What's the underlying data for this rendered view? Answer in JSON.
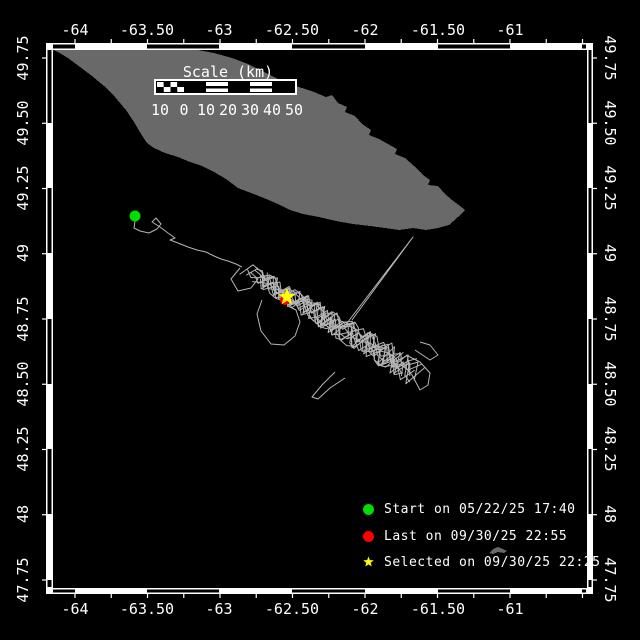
{
  "colors": {
    "background": "#000000",
    "frame": "#ffffff",
    "land": "#696969",
    "track": "#b5b5b5",
    "start_marker": "#00dd00",
    "last_marker": "#ff0000",
    "selected_marker": "#ffff00",
    "text": "#ffffff"
  },
  "axis": {
    "lon_labels": [
      {
        "text": "-64",
        "x": 75
      },
      {
        "text": "-63.50",
        "x": 147
      },
      {
        "text": "-63",
        "x": 219
      },
      {
        "text": "-62.50",
        "x": 292
      },
      {
        "text": "-62",
        "x": 365
      },
      {
        "text": "-61.50",
        "x": 438
      },
      {
        "text": "-61",
        "x": 510
      }
    ],
    "lat_labels": [
      {
        "text": "49.75",
        "y": 58
      },
      {
        "text": "49.50",
        "y": 123
      },
      {
        "text": "49.25",
        "y": 188
      },
      {
        "text": "49",
        "y": 253
      },
      {
        "text": "48.75",
        "y": 319
      },
      {
        "text": "48.50",
        "y": 384
      },
      {
        "text": "48.25",
        "y": 449
      },
      {
        "text": "48",
        "y": 514
      },
      {
        "text": "47.75",
        "y": 580
      }
    ]
  },
  "scalebar": {
    "title": "Scale (km)",
    "labels": [
      "10",
      "0",
      "10",
      "20",
      "30",
      "40",
      "50"
    ],
    "label_xs": [
      160,
      184,
      206,
      228,
      250,
      272,
      294
    ]
  },
  "legend": [
    {
      "marker": "circle",
      "color": "#00dd00",
      "label": "Start on 05/22/25 17:40"
    },
    {
      "marker": "circle",
      "color": "#ff0000",
      "label": "Last on 09/30/25 22:55"
    },
    {
      "marker": "star",
      "color": "#ffff00",
      "label": "Selected on 09/30/25 22:25"
    }
  ],
  "map": {
    "markers": {
      "start": {
        "x": 135,
        "y": 216
      },
      "last": {
        "x": 285,
        "y": 300
      },
      "selected": {
        "x": 287,
        "y": 297
      }
    },
    "land_polygon": [
      [
        53,
        50
      ],
      [
        198,
        50
      ],
      [
        214,
        53
      ],
      [
        232,
        58
      ],
      [
        248,
        64
      ],
      [
        262,
        71
      ],
      [
        276,
        78
      ],
      [
        289,
        84
      ],
      [
        302,
        88
      ],
      [
        314,
        92
      ],
      [
        326,
        97
      ],
      [
        332,
        95
      ],
      [
        338,
        103
      ],
      [
        347,
        107
      ],
      [
        345,
        112
      ],
      [
        355,
        116
      ],
      [
        362,
        124
      ],
      [
        371,
        130
      ],
      [
        369,
        135
      ],
      [
        379,
        139
      ],
      [
        388,
        144
      ],
      [
        397,
        149
      ],
      [
        395,
        154
      ],
      [
        405,
        158
      ],
      [
        414,
        166
      ],
      [
        423,
        175
      ],
      [
        430,
        180
      ],
      [
        428,
        185
      ],
      [
        438,
        186
      ],
      [
        445,
        194
      ],
      [
        452,
        200
      ],
      [
        460,
        206
      ],
      [
        465,
        210
      ],
      [
        458,
        217
      ],
      [
        449,
        225
      ],
      [
        438,
        228
      ],
      [
        426,
        230
      ],
      [
        413,
        228
      ],
      [
        399,
        230
      ],
      [
        385,
        228
      ],
      [
        370,
        226
      ],
      [
        353,
        224
      ],
      [
        336,
        221
      ],
      [
        319,
        217
      ],
      [
        303,
        214
      ],
      [
        290,
        210
      ],
      [
        278,
        204
      ],
      [
        264,
        198
      ],
      [
        251,
        193
      ],
      [
        238,
        188
      ],
      [
        226,
        179
      ],
      [
        214,
        172
      ],
      [
        202,
        166
      ],
      [
        190,
        162
      ],
      [
        178,
        157
      ],
      [
        165,
        153
      ],
      [
        154,
        148
      ],
      [
        147,
        143
      ],
      [
        141,
        134
      ],
      [
        134,
        122
      ],
      [
        126,
        110
      ],
      [
        115,
        97
      ],
      [
        104,
        86
      ],
      [
        92,
        76
      ],
      [
        80,
        67
      ],
      [
        68,
        58
      ],
      [
        58,
        52
      ]
    ],
    "small_island": [
      [
        489,
        553
      ],
      [
        493,
        549
      ],
      [
        498,
        547
      ],
      [
        503,
        549
      ],
      [
        507,
        551
      ],
      [
        504,
        553
      ],
      [
        498,
        552
      ],
      [
        493,
        554
      ]
    ],
    "approach_path": [
      [
        135,
        221
      ],
      [
        134,
        228
      ],
      [
        140,
        231
      ],
      [
        149,
        233
      ],
      [
        157,
        229
      ],
      [
        161,
        224
      ],
      [
        156,
        218
      ],
      [
        152,
        222
      ],
      [
        160,
        227
      ],
      [
        168,
        233
      ],
      [
        175,
        238
      ],
      [
        170,
        240
      ],
      [
        178,
        243
      ],
      [
        188,
        247
      ],
      [
        197,
        250
      ],
      [
        206,
        252
      ],
      [
        214,
        256
      ],
      [
        221,
        259
      ],
      [
        228,
        261
      ],
      [
        236,
        264
      ],
      [
        242,
        267
      ]
    ],
    "cluster": {
      "from": [
        242,
        267
      ],
      "to": [
        420,
        376
      ],
      "strands": 13,
      "half_width_start": 8,
      "half_width_end": 15
    },
    "extra_paths": [
      [
        [
          240,
          268
        ],
        [
          231,
          279
        ],
        [
          238,
          291
        ],
        [
          251,
          288
        ],
        [
          258,
          279
        ],
        [
          250,
          272
        ]
      ],
      [
        [
          262,
          300
        ],
        [
          257,
          314
        ],
        [
          261,
          331
        ],
        [
          271,
          344
        ],
        [
          284,
          345
        ],
        [
          295,
          336
        ],
        [
          300,
          322
        ],
        [
          296,
          310
        ],
        [
          288,
          306
        ]
      ],
      [
        [
          335,
          372
        ],
        [
          322,
          385
        ],
        [
          312,
          397
        ],
        [
          318,
          399
        ],
        [
          330,
          388
        ],
        [
          345,
          378
        ]
      ],
      [
        [
          400,
          360
        ],
        [
          412,
          375
        ],
        [
          420,
          390
        ],
        [
          428,
          385
        ],
        [
          430,
          373
        ],
        [
          420,
          362
        ],
        [
          408,
          356
        ]
      ],
      [
        [
          415,
          350
        ],
        [
          430,
          360
        ],
        [
          438,
          355
        ],
        [
          430,
          345
        ],
        [
          420,
          342
        ]
      ]
    ],
    "spike": {
      "apex": [
        413,
        237
      ],
      "base_a": [
        344,
        327
      ],
      "base_b": [
        352,
        320
      ]
    }
  }
}
